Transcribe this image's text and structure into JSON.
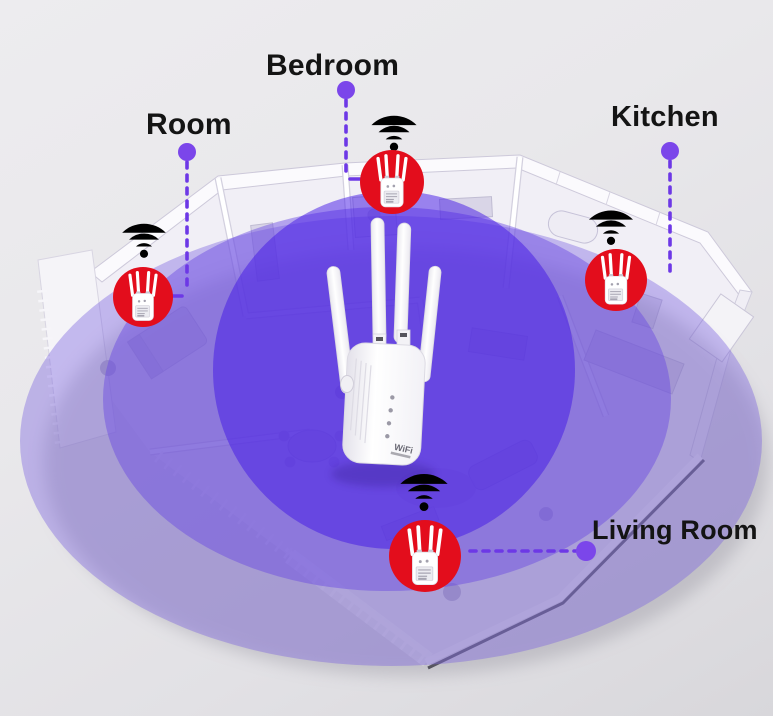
{
  "diagram": {
    "type": "wifi-extender-coverage-floorplan",
    "labels": {
      "room": "Room",
      "bedroom": "Bedroom",
      "kitchen": "Kitchen",
      "living_room": "Living Room"
    },
    "device": {
      "logo": "WiFi"
    },
    "icons": {
      "wifi_signal_icon": "three-white-arcs-with-dot",
      "repeater_icon": "mini-white-extender-with-4-antennas",
      "connector_dot": "filled-purple-circle"
    },
    "colors": {
      "background": "#e9e8eb",
      "coverage_outer": "#7e66e0",
      "coverage_middle": "#6846e2",
      "coverage_inner": "#4216e6",
      "marker_red": "#e30d1c",
      "connector": "#6d38e6",
      "connector_dot": "#7b46ea",
      "label_text": "#141414",
      "wifi_icon": "#ffffff"
    }
  }
}
